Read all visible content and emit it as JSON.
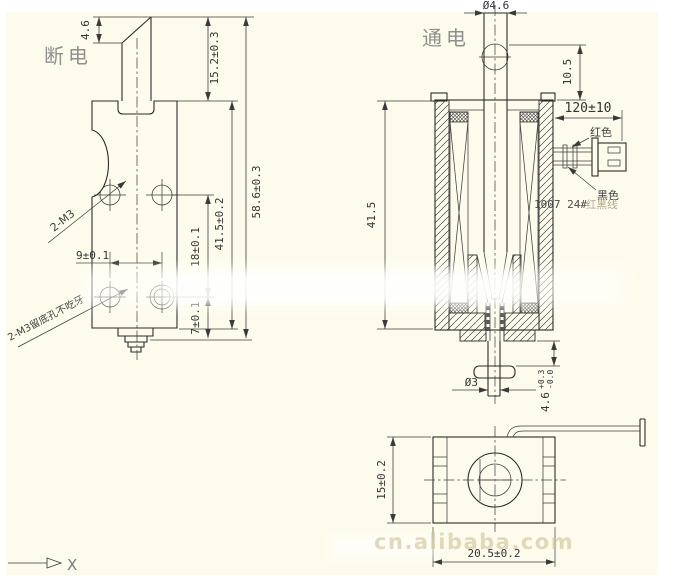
{
  "labels": {
    "left_view": "断电",
    "right_view": "通电",
    "axis_x": "X",
    "watermark": "cn.alibaba.com"
  },
  "left": {
    "bevel": "4.6",
    "plunger_ext": "15.2±0.3",
    "total_h": "58.6±0.3",
    "body_h": "41.5±0.2",
    "hole_v": "18±0.1",
    "hole_h": "9±0.1",
    "hole_bottom": "7±0.1",
    "thread_note": "2-M3",
    "blind_note": "2-M3留底孔不吃牙"
  },
  "right": {
    "rod_dia": "Ø4.6",
    "hole_pos": "10.5",
    "wire_len": "120±10",
    "body_h": "41.5",
    "shaft_dia": "Ø3",
    "stroke": "4.6",
    "stroke_tol_plus": "+0.3",
    "stroke_tol_minus": "-0.0",
    "wire_red": "红色",
    "wire_black": "黑色",
    "wire_spec": "1007 24#",
    "wire_spec_suffix": "红黑线"
  },
  "bottom": {
    "depth": "15±0.2",
    "width": "20.5±0.2"
  }
}
